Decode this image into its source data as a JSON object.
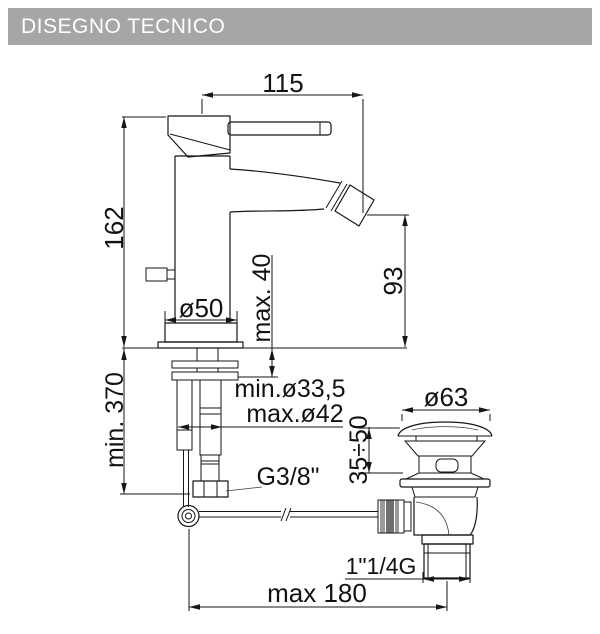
{
  "header": {
    "title": "DISEGNO TECNICO",
    "bg_color": "#a6a6a6",
    "text_color": "#ffffff"
  },
  "drawing": {
    "line_color": "#161616",
    "knurl_dark_color": "#6f6f6f",
    "knurl_light_color": "#9a9a9a",
    "dimensions": {
      "spout_reach": "115",
      "total_height": "162",
      "spout_height": "93",
      "max_deck_thickness": "max. 40",
      "base_diameter": "ø50",
      "hole_min_diameter": "min.ø33,5",
      "hole_max_diameter": "max.ø42",
      "min_hose_length": "min. 370",
      "supply_thread": "G3/8\"",
      "drain_cap_diameter": "ø63",
      "drain_clamp_range": "35÷50",
      "drain_thread": "1\"1/4G",
      "max_rod_length": "max 180"
    }
  }
}
